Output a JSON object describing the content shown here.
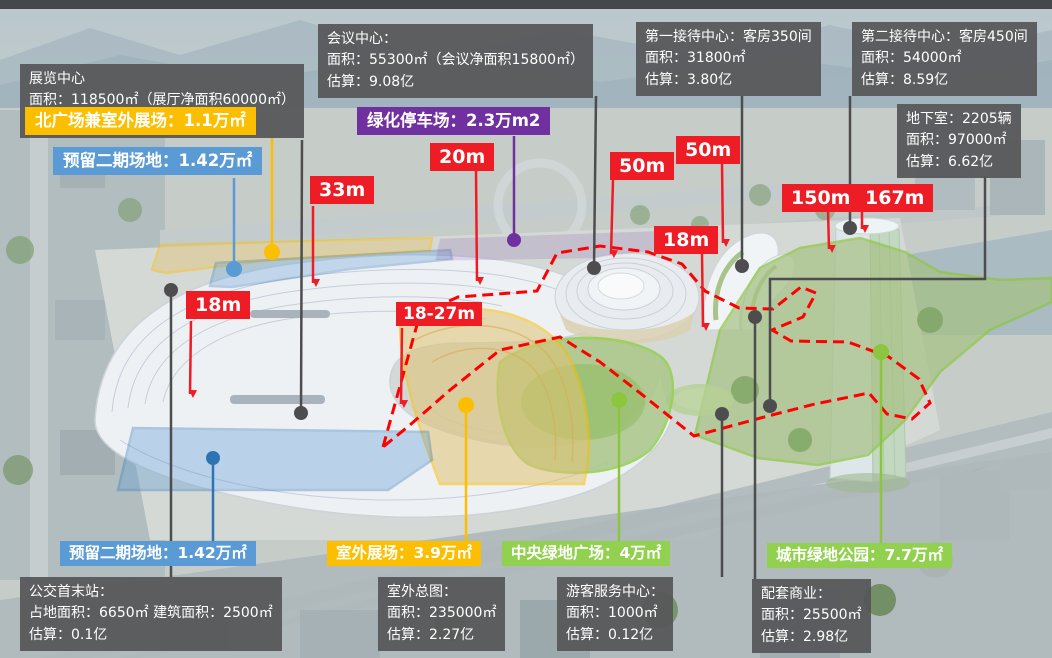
{
  "title": "会展中心项目总体指标标注图",
  "colors": {
    "red": "#EE1C25",
    "yellow": "#FBBE00",
    "blue": "#5B9BD5",
    "purple": "#7030A0",
    "green": "#92D050",
    "dark_box": "#58595B",
    "dashed_boundary": "#FF0000",
    "connector": "#4D4D4F"
  },
  "info_boxes": {
    "exhibition": [
      "展览中心",
      "面积：118500㎡（展厅净面积60000㎡）",
      "估算：16.04亿"
    ],
    "conference": [
      "会议中心：",
      "面积：55300㎡（会议净面积15800㎡）",
      "估算：9.08亿"
    ],
    "reception1": [
      "第一接待中心：客房350间",
      "面积：31800㎡",
      "估算：3.80亿"
    ],
    "reception2": [
      "第二接待中心：客房450间",
      "面积：54000㎡",
      "估算：8.59亿"
    ],
    "basement": [
      "地下室：2205辆",
      "面积：97000㎡",
      "估算：6.62亿"
    ],
    "bus_station": [
      "公交首末站：",
      "占地面积：6650㎡ 建筑面积：2500㎡",
      "估算：0.1亿"
    ],
    "outdoor_master": [
      "室外总图：",
      "面积：235000㎡",
      "估算：2.27亿"
    ],
    "visitor_center": [
      "游客服务中心：",
      "面积：1000㎡",
      "估算：0.12亿"
    ],
    "retail": [
      "配套商业：",
      "面积：25500㎡",
      "估算：2.98亿"
    ]
  },
  "area_labels": {
    "north_plaza": "北广场兼室外展场：1.1万㎡",
    "reserved_phase2_top": "预留二期场地：1.42万㎡",
    "green_parking": "绿化停车场：2.3万m2",
    "reserved_phase2_bottom": "预留二期场地：1.42万㎡",
    "outdoor_exhibition": "室外展场：3.9万㎡",
    "central_green_plaza": "中央绿地广场：4万㎡",
    "city_green_park": "城市绿地公园：7.7万㎡"
  },
  "measures": {
    "m33": "33m",
    "m20": "20m",
    "m50_left": "50m",
    "m50_right": "50m",
    "m18_mid": "18m",
    "m150": "150m",
    "m167": "167m",
    "m18_left": "18m",
    "m18_27": "18-27m"
  }
}
